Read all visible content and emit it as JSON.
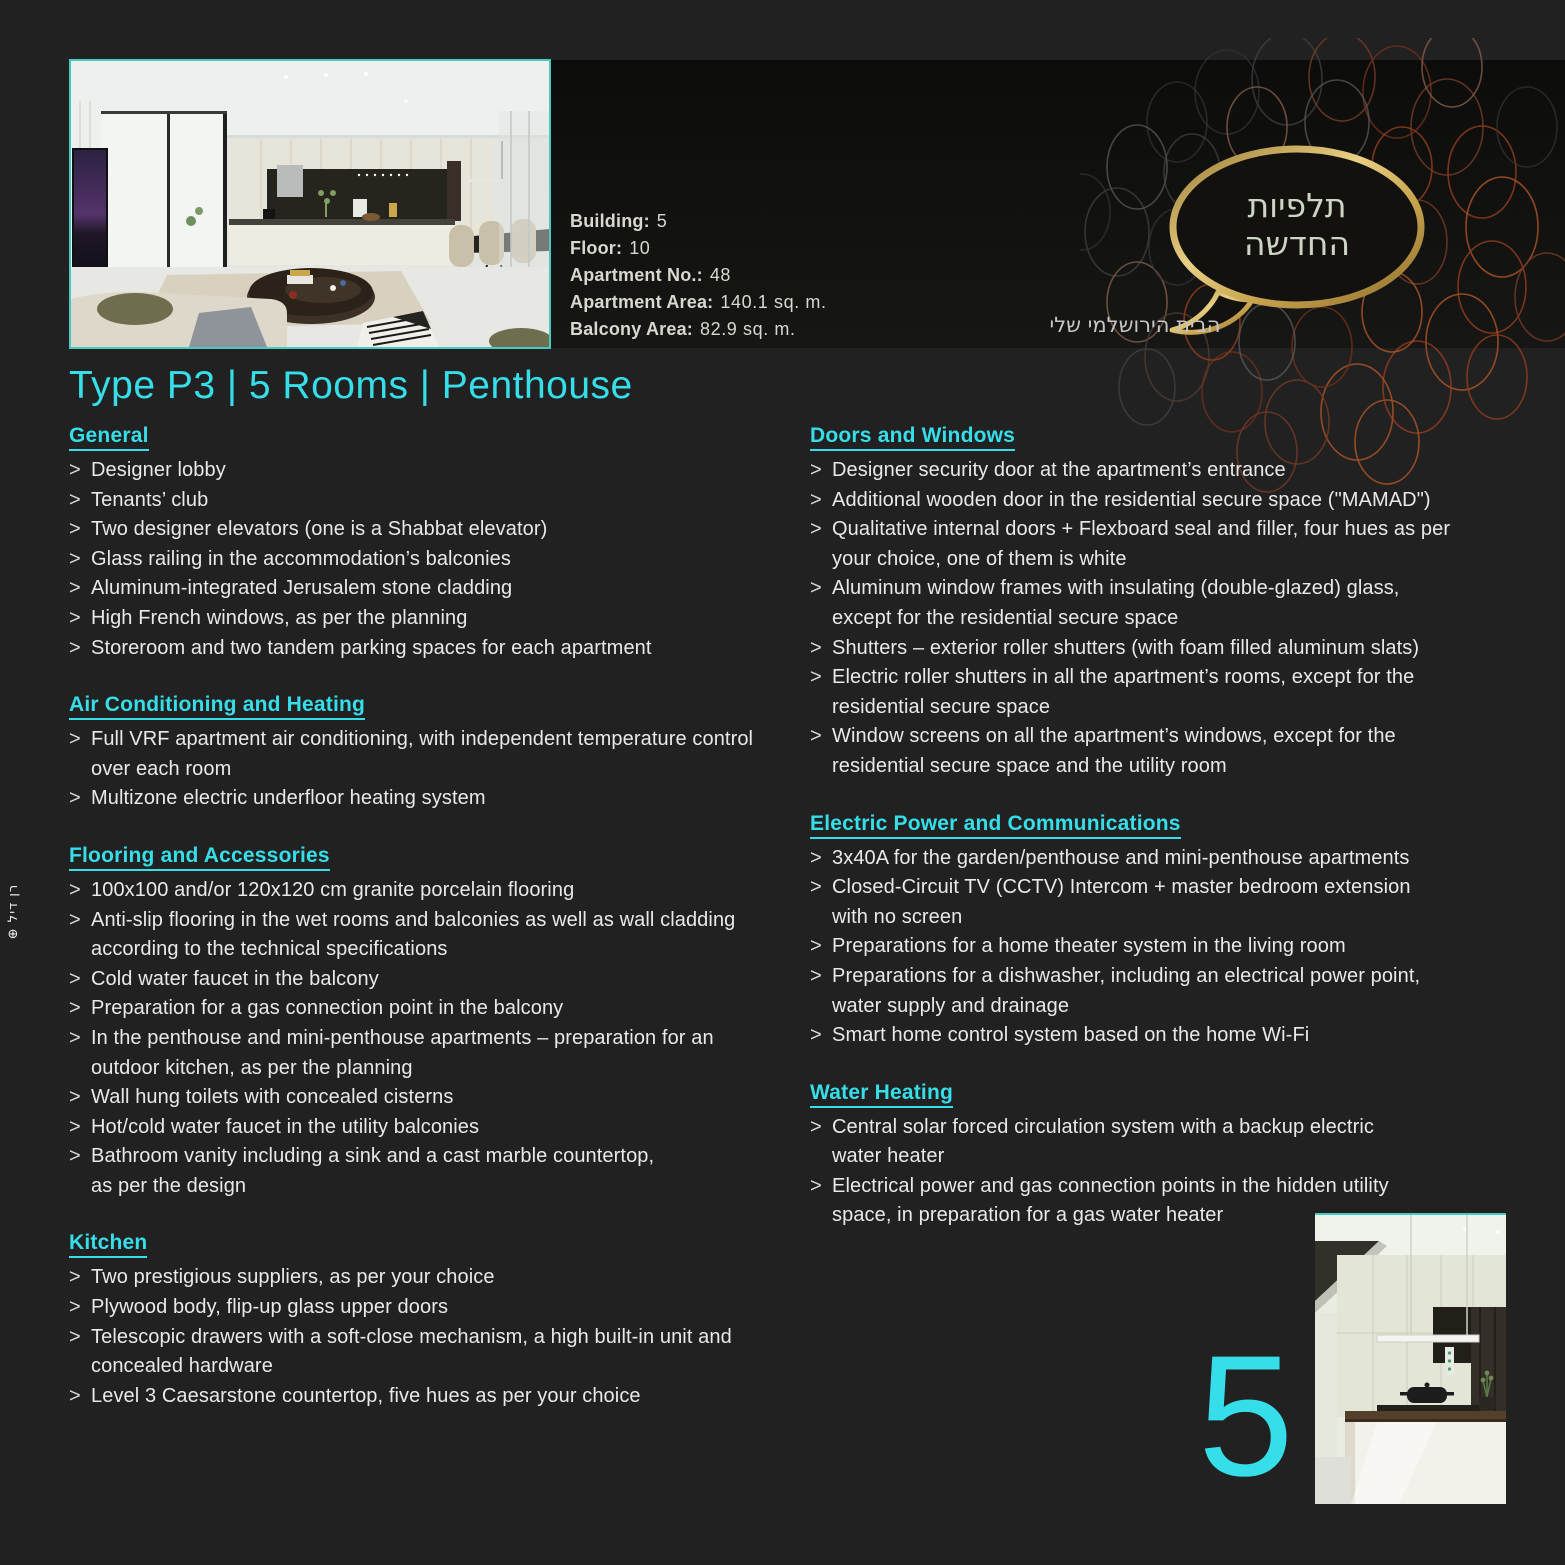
{
  "colors": {
    "accent": "#35dee8",
    "gold": "#d2b05c",
    "band": "#111110",
    "background": "#212121",
    "body_text": "#e9e9e7"
  },
  "list_marker": ">",
  "meta": {
    "specs": [
      {
        "label": "Building:",
        "value": "5"
      },
      {
        "label": "Floor:",
        "value": "10"
      },
      {
        "label": "Apartment No.:",
        "value": "48"
      },
      {
        "label": "Apartment Area:",
        "value": "140.1 sq. m."
      },
      {
        "label": "Balcony Area:",
        "value": "82.9 sq. m."
      }
    ]
  },
  "logo": {
    "line1": "תלפיות",
    "line2": "החדשה",
    "tagline": "הבית הירושלמי שלי"
  },
  "title": "Type P3 | 5 Rooms | Penthouse",
  "page_number": "5",
  "side_credit": "רן דיל ⊕",
  "columns": {
    "left": [
      {
        "heading": "General",
        "items": [
          [
            "Designer lobby"
          ],
          [
            "Tenants’ club"
          ],
          [
            "Two designer elevators (one is a Shabbat elevator)"
          ],
          [
            "Glass railing in the accommodation’s balconies"
          ],
          [
            "Aluminum-integrated Jerusalem stone cladding"
          ],
          [
            "High French windows, as per the planning"
          ],
          [
            "Storeroom and two tandem parking spaces for each apartment"
          ]
        ]
      },
      {
        "heading": "Air Conditioning and Heating",
        "items": [
          [
            "Full VRF apartment air conditioning, with independent temperature control",
            "over each room"
          ],
          [
            "Multizone electric underfloor heating system"
          ]
        ]
      },
      {
        "heading": "Flooring and Accessories",
        "items": [
          [
            "100x100 and/or 120x120 cm granite porcelain flooring"
          ],
          [
            "Anti-slip flooring in the wet rooms and balconies as well as wall cladding",
            "according to the technical specifications"
          ],
          [
            "Cold water faucet in the balcony"
          ],
          [
            "Preparation for a gas connection point in the balcony"
          ],
          [
            "In the penthouse and mini-penthouse apartments – preparation for an",
            "outdoor kitchen, as per the planning"
          ],
          [
            "Wall hung toilets with concealed cisterns"
          ],
          [
            "Hot/cold water faucet in the utility balconies"
          ],
          [
            "Bathroom vanity including a sink and a cast marble countertop,",
            "as per the design"
          ]
        ]
      },
      {
        "heading": "Kitchen",
        "items": [
          [
            "Two prestigious suppliers, as per your choice"
          ],
          [
            "Plywood body, flip-up glass upper doors"
          ],
          [
            "Telescopic drawers with a soft-close mechanism, a high built-in unit and",
            "concealed hardware"
          ],
          [
            "Level 3 Caesarstone countertop, five hues as per your choice"
          ]
        ]
      }
    ],
    "right": [
      {
        "heading": "Doors and Windows",
        "items": [
          [
            "Designer security door at the apartment’s entrance"
          ],
          [
            "Additional wooden door in the residential secure space (\"MAMAD\")"
          ],
          [
            "Qualitative internal doors + Flexboard seal and filler, four hues as per",
            "your choice, one of them is white"
          ],
          [
            "Aluminum window frames with insulating (double-glazed) glass,",
            "except for the residential secure space"
          ],
          [
            "Shutters – exterior roller shutters (with foam filled aluminum slats)"
          ],
          [
            "Electric roller shutters in all the apartment’s rooms, except for the",
            "residential secure space"
          ],
          [
            "Window screens on all the apartment’s windows, except for the",
            "residential secure space and the utility room"
          ]
        ]
      },
      {
        "heading": "Electric Power and Communications",
        "items": [
          [
            "3x40A for the garden/penthouse and mini-penthouse apartments"
          ],
          [
            "Closed-Circuit TV (CCTV) Intercom + master bedroom extension",
            "with no screen"
          ],
          [
            "Preparations for a home theater system in the living room"
          ],
          [
            "Preparations for a dishwasher, including an electrical power point,",
            "water supply and drainage"
          ],
          [
            "Smart home control system based on the home Wi-Fi"
          ]
        ]
      },
      {
        "heading": "Water Heating",
        "items": [
          [
            "Central solar forced circulation system with a backup electric",
            "water heater"
          ],
          [
            "Electrical power and gas connection points in the hidden utility",
            "space, in preparation for a gas water heater"
          ]
        ]
      }
    ]
  }
}
